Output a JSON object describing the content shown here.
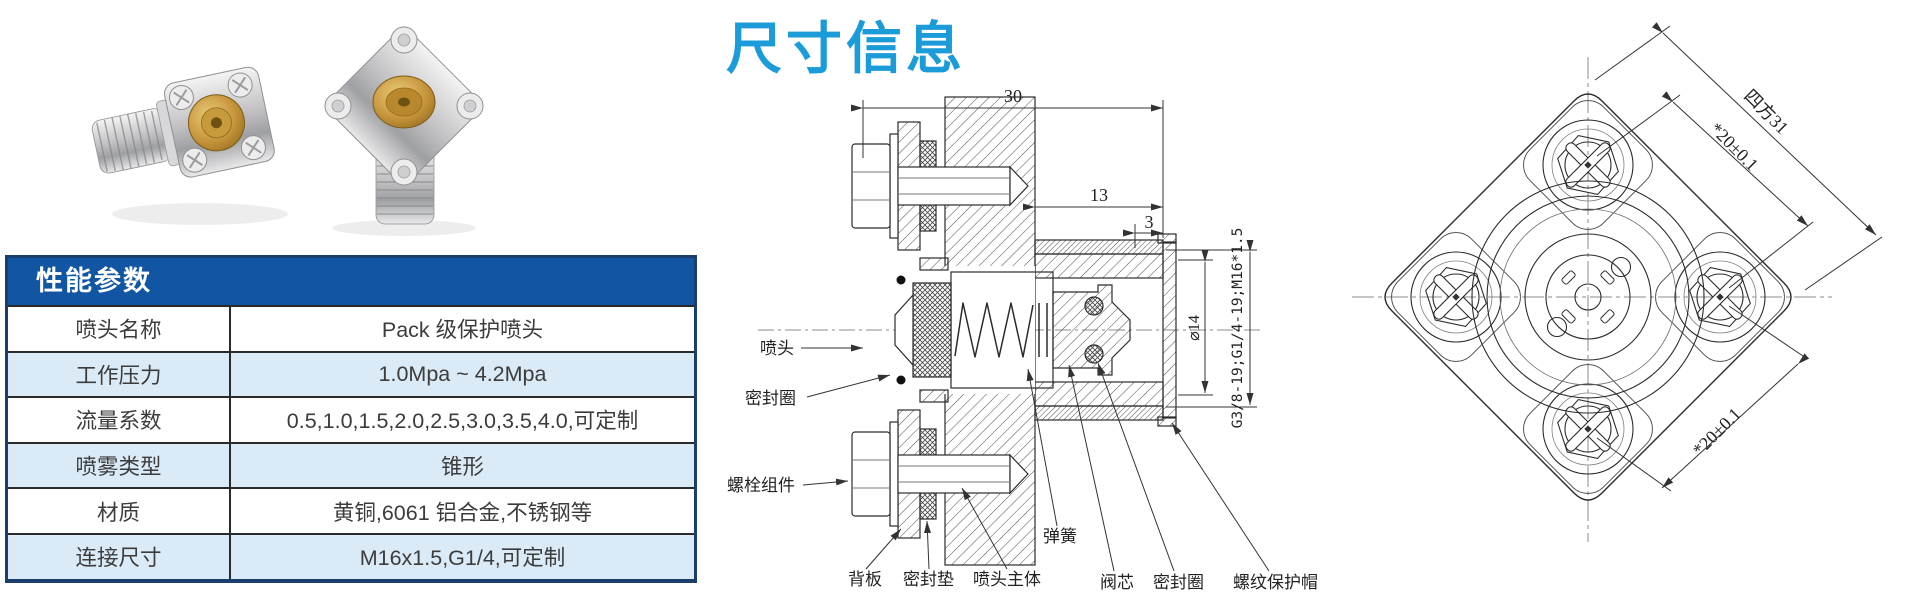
{
  "title": {
    "text": "尺寸信息",
    "color": "#1b9bd8"
  },
  "spec_table": {
    "header": "性能参数",
    "header_bg": "#1155a3",
    "alt_row_bg": "#daeaf7",
    "border_color": "#1b3e6c",
    "rows": [
      {
        "label": "喷头名称",
        "value": "Pack 级保护喷头"
      },
      {
        "label": "工作压力",
        "value": "1.0Mpa ~ 4.2Mpa"
      },
      {
        "label": "流量系数",
        "value": "0.5,1.0,1.5,2.0,2.5,3.0,3.5,4.0,可定制"
      },
      {
        "label": "喷雾类型",
        "value": "锥形"
      },
      {
        "label": "材质",
        "value": "黄铜,6061 铝合金,不锈钢等"
      },
      {
        "label": "连接尺寸",
        "value": "M16x1.5,G1/4,可定制"
      }
    ]
  },
  "section_view": {
    "dimensions": {
      "overall_length": "30",
      "body_length": "13",
      "tip_length": "3",
      "bore_diameter": "⌀14",
      "thread_spec": "G3/8-19;G1/4-19;M16*1.5"
    },
    "labels": {
      "nozzle": "喷头",
      "seal_ring_left": "密封圈",
      "bolt_assembly": "螺栓组件",
      "back_plate": "背板",
      "seal_gasket": "密封垫",
      "nozzle_body": "喷头主体",
      "spring": "弹簧",
      "valve_core": "阀芯",
      "seal_ring_right": "密封圈",
      "thread_cap": "螺纹保护帽"
    }
  },
  "front_view": {
    "dimensions": {
      "square_size": "四方31",
      "hole_pitch_top": "*20±0.1",
      "hole_pitch_bottom": "*20±0.1"
    }
  }
}
